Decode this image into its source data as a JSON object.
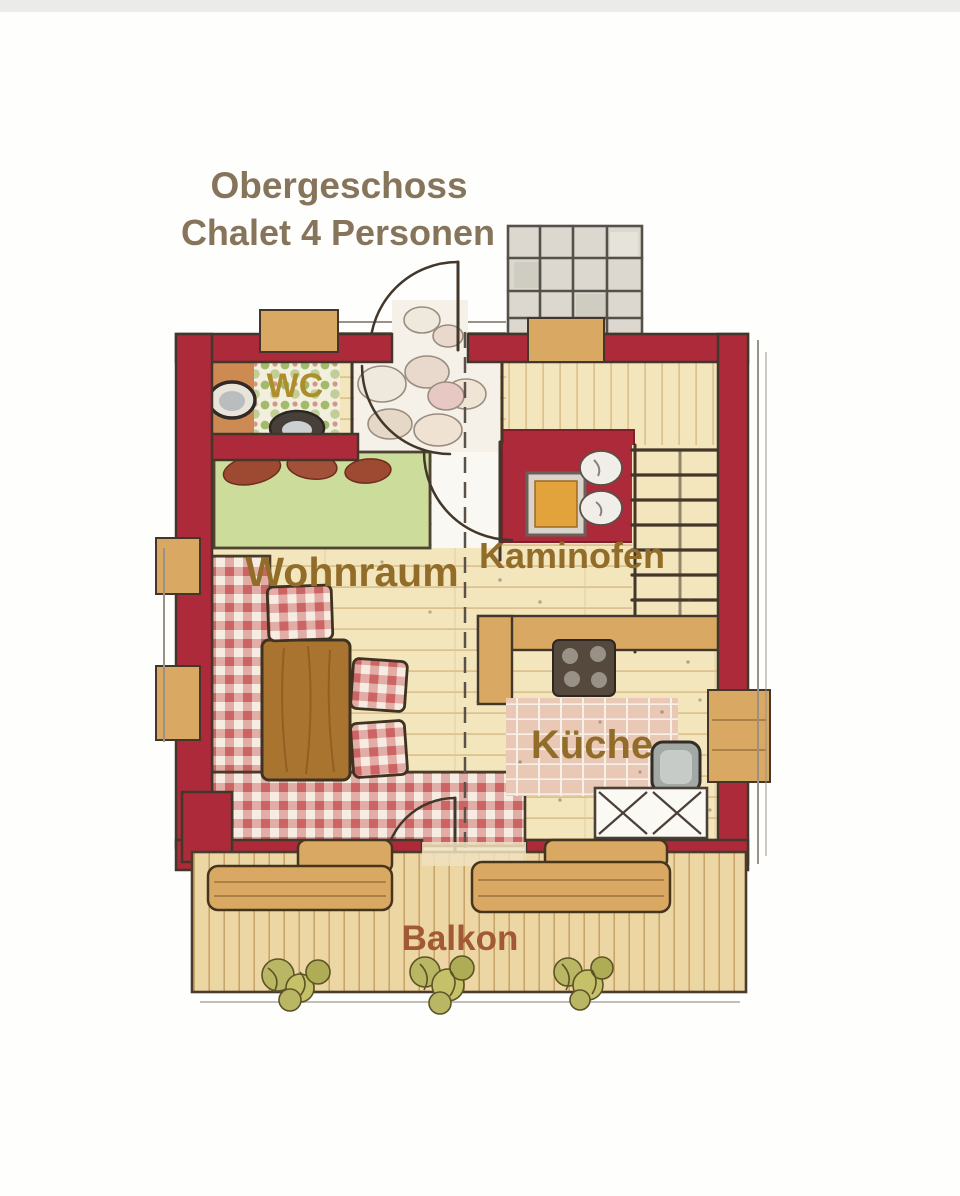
{
  "title": {
    "line1": "Obergeschoss",
    "line2": "Chalet 4 Personen"
  },
  "rooms": {
    "wc": "WC",
    "wohnraum": "Wohnraum",
    "kaminofen": "Kaminofen",
    "kueche": "Küche",
    "balkon": "Balkon"
  },
  "colors": {
    "wall-red": "#ac2a3a",
    "wood-floor": "#f3e5bc",
    "wood-line": "#dcc28e",
    "wood-beam": "#d9a963",
    "deck-wood": "#ecd6a4",
    "deck-line": "#c8a468",
    "table-wood": "#a9742f",
    "bed-green": "#ccdc9a",
    "check-red": "#c24848",
    "wc-green": "#8fae4e",
    "floor-orange": "#cd8a52",
    "tile-pink": "#e9c9b6",
    "stone-gray": "#dcd8cf",
    "fire-orange": "#e2a23c",
    "cooktop-dark": "#55493d",
    "sink-gray": "#a2a8a4",
    "outline-dark": "#43362a",
    "label-brown": "#926d2a",
    "title-brown": "#86755a",
    "balkon-brown": "#a25936",
    "wc-label-yellow": "#ac8f2c"
  }
}
